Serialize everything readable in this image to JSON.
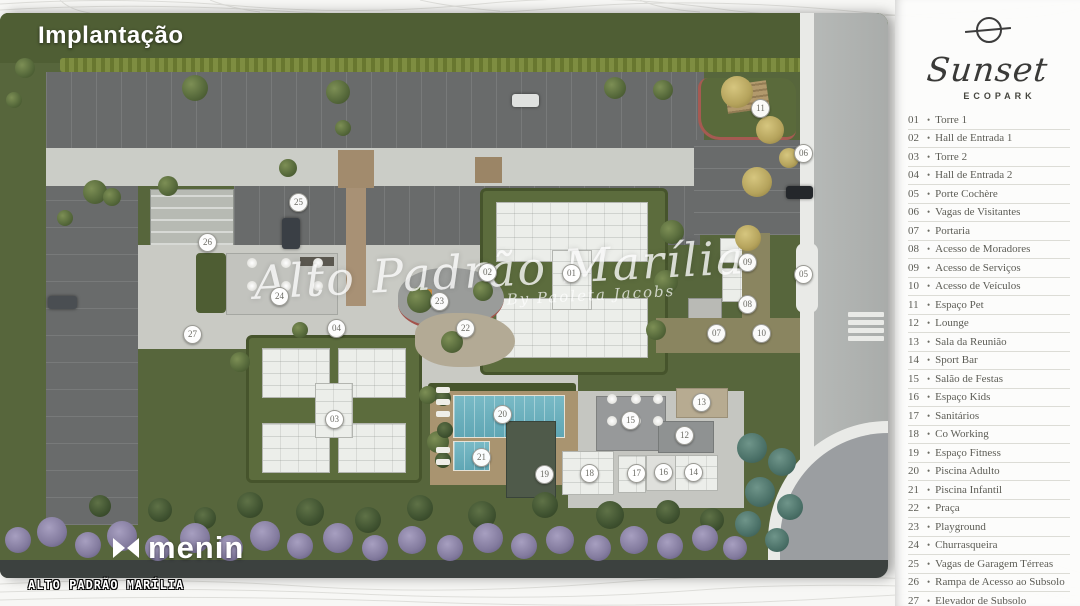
{
  "title": "Implantação",
  "brand": {
    "name": "Sunset",
    "subname": "ECOPARK",
    "icon": "sunset-sun-icon"
  },
  "legend": {
    "items": [
      {
        "num": "01",
        "label": "Torre 1"
      },
      {
        "num": "02",
        "label": "Hall de Entrada 1"
      },
      {
        "num": "03",
        "label": "Torre 2"
      },
      {
        "num": "04",
        "label": "Hall de Entrada 2"
      },
      {
        "num": "05",
        "label": "Porte Cochère"
      },
      {
        "num": "06",
        "label": "Vagas de Visitantes"
      },
      {
        "num": "07",
        "label": "Portaria"
      },
      {
        "num": "08",
        "label": "Acesso de Moradores"
      },
      {
        "num": "09",
        "label": "Acesso de Serviços"
      },
      {
        "num": "10",
        "label": "Acesso de Veículos"
      },
      {
        "num": "11",
        "label": "Espaço Pet"
      },
      {
        "num": "12",
        "label": "Lounge"
      },
      {
        "num": "13",
        "label": "Sala da Reunião"
      },
      {
        "num": "14",
        "label": "Sport Bar"
      },
      {
        "num": "15",
        "label": "Salão de Festas"
      },
      {
        "num": "16",
        "label": "Espaço Kids"
      },
      {
        "num": "17",
        "label": "Sanitários"
      },
      {
        "num": "18",
        "label": "Co Working"
      },
      {
        "num": "19",
        "label": "Espaço Fitness"
      },
      {
        "num": "20",
        "label": "Piscina Adulto"
      },
      {
        "num": "21",
        "label": "Piscina Infantil"
      },
      {
        "num": "22",
        "label": "Praça"
      },
      {
        "num": "23",
        "label": "Playground"
      },
      {
        "num": "24",
        "label": "Churrasqueira"
      },
      {
        "num": "25",
        "label": "Vagas de Garagem Térreas"
      },
      {
        "num": "26",
        "label": "Rampa de Acesso ao Subsolo"
      },
      {
        "num": "27",
        "label": "Elevador de Subsolo"
      }
    ]
  },
  "map": {
    "markers": [
      {
        "num": "01",
        "x": 571,
        "y": 273
      },
      {
        "num": "02",
        "x": 487,
        "y": 272
      },
      {
        "num": "03",
        "x": 334,
        "y": 419
      },
      {
        "num": "04",
        "x": 336,
        "y": 328
      },
      {
        "num": "05",
        "x": 803,
        "y": 274
      },
      {
        "num": "06",
        "x": 803,
        "y": 153
      },
      {
        "num": "07",
        "x": 716,
        "y": 333
      },
      {
        "num": "08",
        "x": 747,
        "y": 304
      },
      {
        "num": "09",
        "x": 747,
        "y": 262
      },
      {
        "num": "10",
        "x": 761,
        "y": 333
      },
      {
        "num": "11",
        "x": 760,
        "y": 108
      },
      {
        "num": "12",
        "x": 684,
        "y": 435
      },
      {
        "num": "13",
        "x": 701,
        "y": 402
      },
      {
        "num": "14",
        "x": 693,
        "y": 472
      },
      {
        "num": "15",
        "x": 630,
        "y": 420
      },
      {
        "num": "16",
        "x": 663,
        "y": 472
      },
      {
        "num": "17",
        "x": 636,
        "y": 473
      },
      {
        "num": "18",
        "x": 589,
        "y": 473
      },
      {
        "num": "19",
        "x": 544,
        "y": 474
      },
      {
        "num": "20",
        "x": 502,
        "y": 414
      },
      {
        "num": "21",
        "x": 481,
        "y": 457
      },
      {
        "num": "22",
        "x": 465,
        "y": 328
      },
      {
        "num": "23",
        "x": 439,
        "y": 301
      },
      {
        "num": "24",
        "x": 279,
        "y": 296
      },
      {
        "num": "25",
        "x": 298,
        "y": 202
      },
      {
        "num": "26",
        "x": 207,
        "y": 242
      },
      {
        "num": "27",
        "x": 192,
        "y": 334
      }
    ]
  },
  "watermark": {
    "line1": "Alto Padrão Marília",
    "line2": "By Paoleta Jacobs"
  },
  "footer": {
    "developer": "menin",
    "caption": "ALTO PADRÃO MARÍLIA"
  }
}
